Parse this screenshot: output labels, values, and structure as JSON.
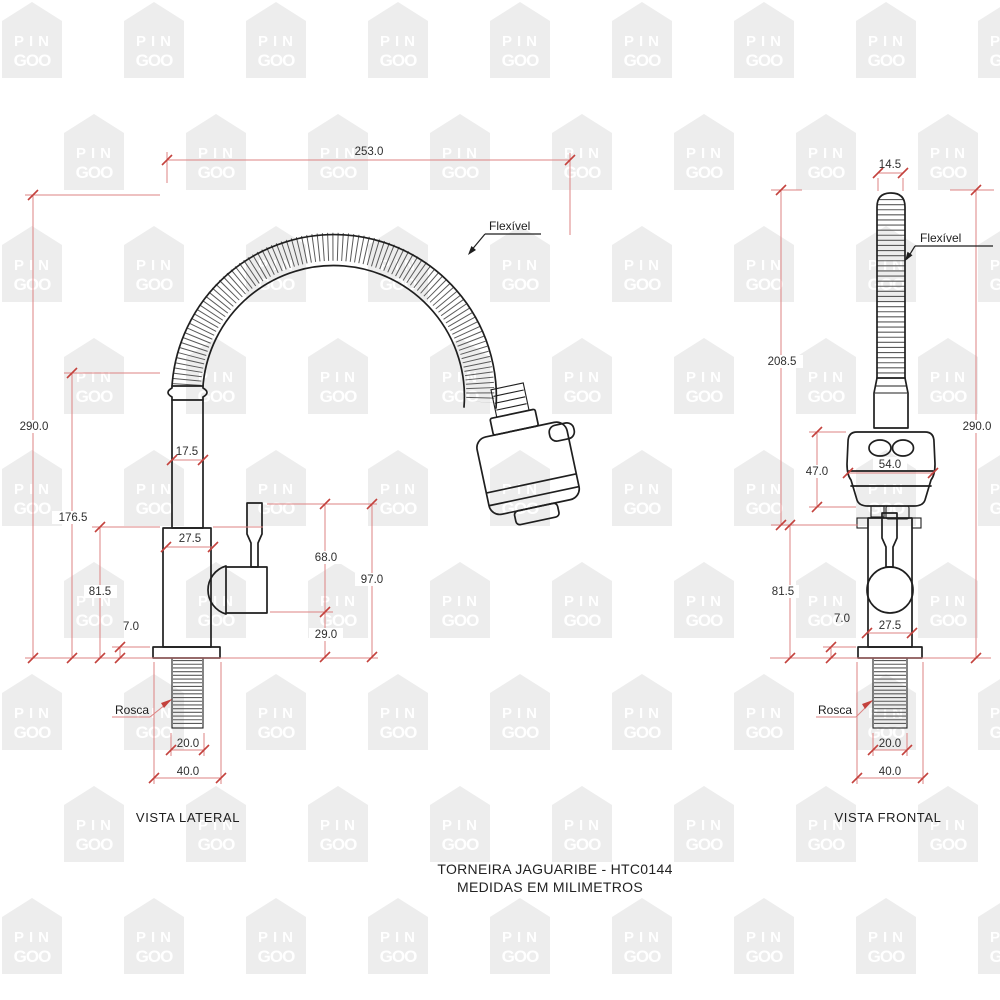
{
  "watermark": {
    "line1": "PIN",
    "line2": "GOO"
  },
  "colors": {
    "dimension_line": "#dd8383",
    "dimension_tick": "#c4423d",
    "drawing_line": "#1f1f1f",
    "watermark_fill": "#ededed",
    "watermark_text": "#ffffff"
  },
  "title_block": {
    "line1": "TORNEIRA JAGUARIBE - HTC0144",
    "line2": "MEDIDAS EM MILIMETROS"
  },
  "lateral_view": {
    "title": "VISTA LATERAL",
    "labels": {
      "flexible_hose": "Flexível",
      "thread": "Rosca"
    },
    "dims": {
      "total_width": "253.0",
      "total_height": "290.0",
      "hose_connection_height": "176.5",
      "body_height": "81.5",
      "base_thickness": "7.0",
      "pipe_width": "17.5",
      "body_width": "27.5",
      "handle_drop": "68.0",
      "handle_total_drop": "97.0",
      "handle_base_offset": "29.0",
      "thread_width": "20.0",
      "base_width": "40.0"
    }
  },
  "frontal_view": {
    "title": "VISTA FRONTAL",
    "labels": {
      "flexible_hose": "Flexível",
      "thread": "Rosca"
    },
    "dims": {
      "hose_width": "14.5",
      "hose_section_height": "208.5",
      "total_height": "290.0",
      "spray_head_height": "47.0",
      "spray_head_width": "54.0",
      "body_height": "81.5",
      "base_thickness": "7.0",
      "body_width": "27.5",
      "thread_width": "20.0",
      "base_width": "40.0"
    }
  }
}
